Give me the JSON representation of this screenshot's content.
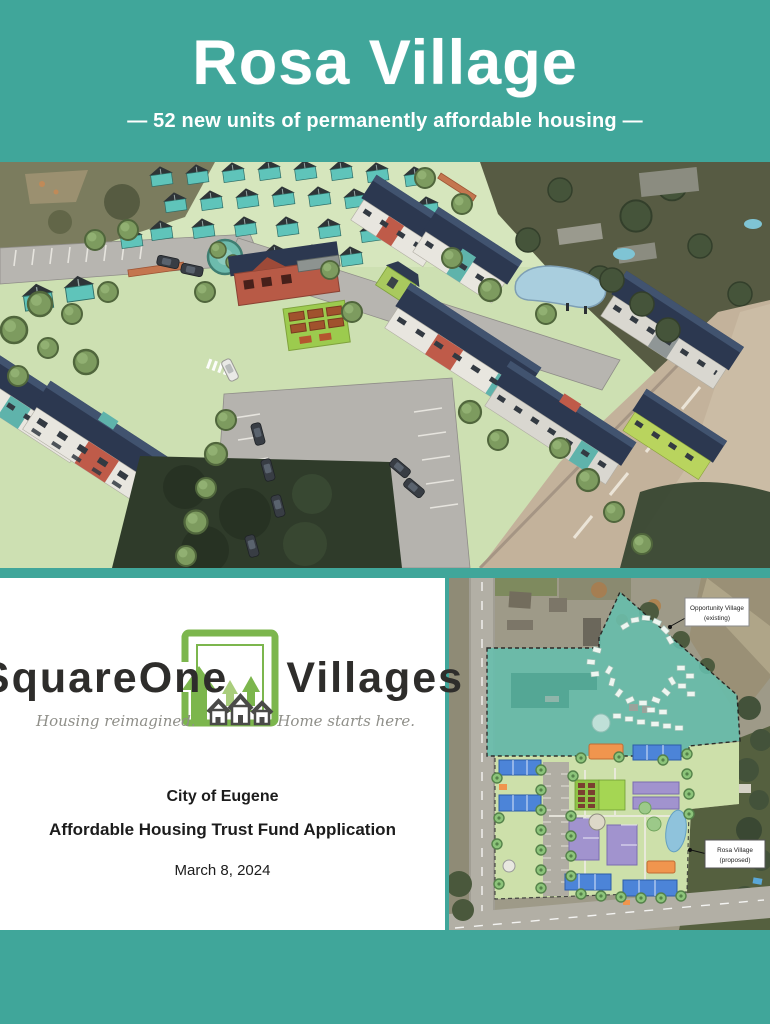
{
  "header": {
    "title": "Rosa Village",
    "subtitle": "— 52 new units of permanently affordable housing —"
  },
  "logo": {
    "word_left": "SquareOne",
    "word_right": "Villages",
    "tagline_left": "Housing reimagined.",
    "tagline_right": "Home starts here."
  },
  "card": {
    "org": "City of Eugene",
    "application": "Affordable Housing Trust Fund Application",
    "date": "March 8, 2024"
  },
  "site_plan": {
    "label_existing_line1": "Opportunity Village",
    "label_existing_line2": "(existing)",
    "label_proposed_line1": "Rosa Village",
    "label_proposed_line2": "(proposed)"
  },
  "colors": {
    "teal_background": "#40A69A",
    "logo_green": "#7CB64D",
    "plan_overlay_teal": "#66BFAD",
    "plan_building_blue": "#4C84D8",
    "plan_building_purple": "#A193CE",
    "plan_building_orange": "#F0954E"
  }
}
